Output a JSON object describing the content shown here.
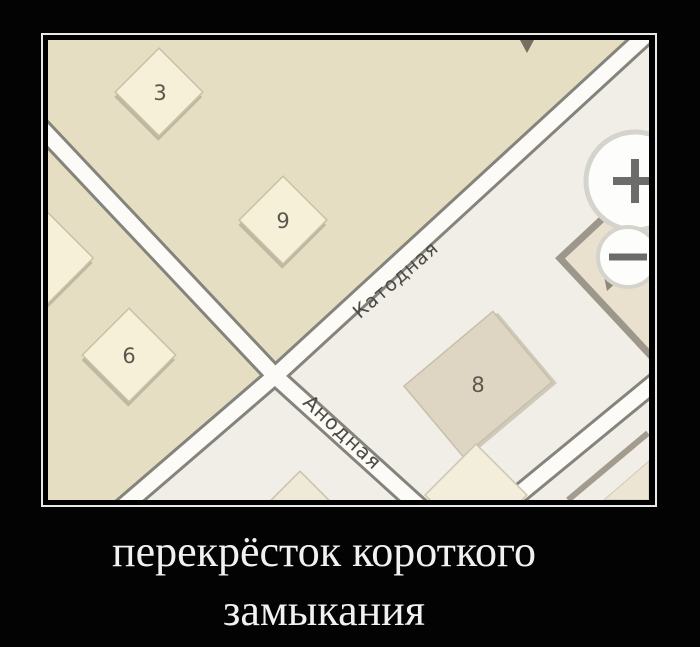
{
  "meme": {
    "caption_line1": "перекрёсток короткого",
    "caption_line2": "замыкания"
  },
  "map": {
    "streets": [
      {
        "name": "Катодная"
      },
      {
        "name": "Анодная"
      }
    ],
    "buildings": [
      {
        "number": "3"
      },
      {
        "number": "9"
      },
      {
        "number": "6"
      },
      {
        "number": "8"
      }
    ],
    "controls": {
      "zoom_in_icon": "plus",
      "zoom_out_icon": "minus"
    }
  },
  "colors": {
    "page_background": "#030303",
    "frame_border": "#e8e8e6",
    "land_block": "#e6dec3",
    "land_base": "#f0eee6",
    "road_fill": "#fcfbf7",
    "road_casing": "#85847c",
    "building_fill": "#f6f0d8",
    "building_8_fill": "#ded5c3",
    "street_text": "#4b4a44",
    "caption_text": "#f1f1f1"
  }
}
